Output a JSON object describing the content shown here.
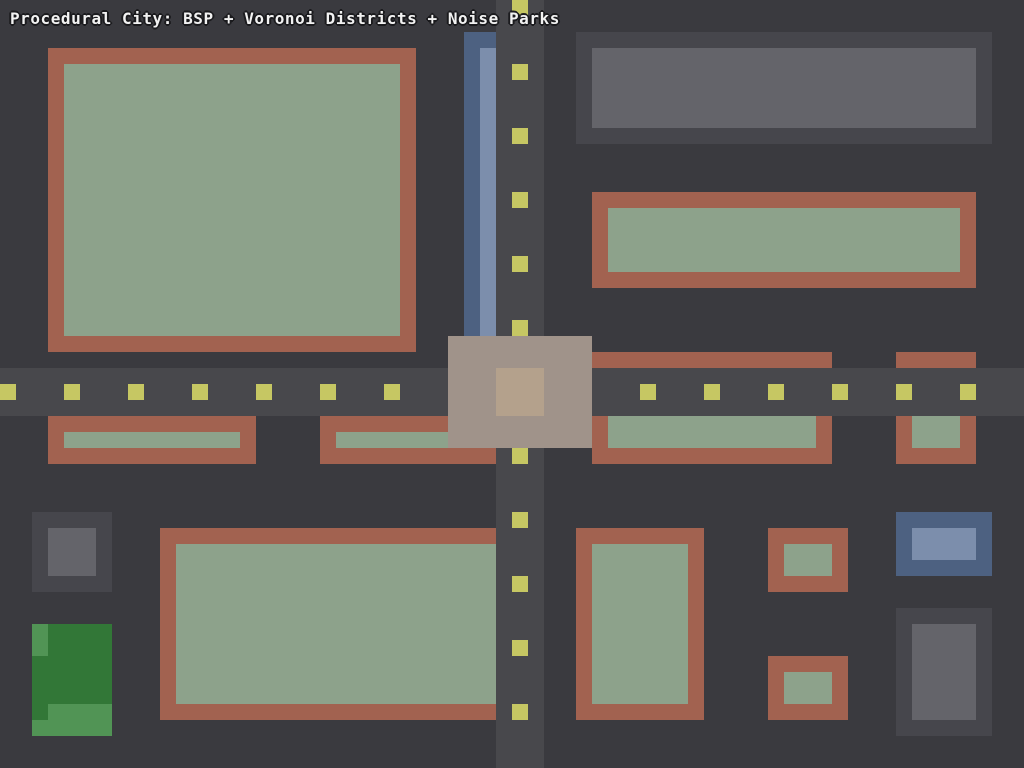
{
  "header": {
    "title": "Procedural City: BSP + Voronoi Districts + Noise Parks"
  },
  "scene": {
    "width": 1024,
    "height": 768,
    "background_color": "#3a3a3f",
    "palette": {
      "road": "#48484c",
      "road_dash": "#c6c763",
      "building_border_brown": "#a26250",
      "building_fill_green": "#8da28b",
      "building_border_gray": "#46464c",
      "building_fill_gray": "#64646a",
      "building_border_blue": "#4d6181",
      "building_fill_blue": "#7c8eac",
      "plaza_outer": "#a0938a",
      "plaza_inner": "#b4a18c",
      "park_dark": "#327737",
      "park_light": "#519455",
      "title_text": "#f2f2f2"
    },
    "roads": [
      {
        "name": "road-vertical",
        "x": 496,
        "y": 0,
        "w": 48,
        "h": 768,
        "color": "#48484c"
      },
      {
        "name": "road-horizontal",
        "x": 0,
        "y": 368,
        "w": 1024,
        "h": 48,
        "color": "#48484c"
      }
    ],
    "dashes": {
      "color": "#c6c763",
      "size": 16,
      "vertical_lane_x": 512,
      "vertical_dash_ys": [
        0,
        64,
        128,
        192,
        256,
        320,
        448,
        512,
        576,
        640,
        704
      ],
      "horizontal_lane_y": 384,
      "horizontal_dash_xs": [
        0,
        64,
        128,
        192,
        256,
        320,
        384,
        640,
        704,
        768,
        832,
        896,
        960
      ]
    },
    "buildings": [
      {
        "name": "building-residential-topleft-large",
        "outer": {
          "x": 48,
          "y": 48,
          "w": 368,
          "h": 304,
          "color": "#a26250"
        },
        "inner": {
          "x": 64,
          "y": 64,
          "w": 336,
          "h": 272,
          "color": "#8da28b"
        }
      },
      {
        "name": "building-commercial-topright-gray",
        "outer": {
          "x": 576,
          "y": 32,
          "w": 416,
          "h": 112,
          "color": "#46464c"
        },
        "inner": {
          "x": 592,
          "y": 48,
          "w": 384,
          "h": 80,
          "color": "#64646a"
        }
      },
      {
        "name": "building-residential-midright-wide",
        "outer": {
          "x": 592,
          "y": 192,
          "w": 384,
          "h": 96,
          "color": "#a26250"
        },
        "inner": {
          "x": 608,
          "y": 208,
          "w": 352,
          "h": 64,
          "color": "#8da28b"
        }
      },
      {
        "name": "building-civic-blue-top-roadside",
        "outer": {
          "x": 464,
          "y": 32,
          "w": 80,
          "h": 304,
          "color": "#4d6181"
        },
        "inner": {
          "x": 480,
          "y": 48,
          "w": 64,
          "h": 288,
          "color": "#7c8eac"
        }
      },
      {
        "name": "building-strip-right-of-plaza",
        "outer": {
          "x": 592,
          "y": 352,
          "w": 240,
          "h": 112,
          "color": "#a26250"
        },
        "inner": {
          "x": 608,
          "y": 368,
          "w": 208,
          "h": 80,
          "color": "#8da28b"
        }
      },
      {
        "name": "building-strip-far-right",
        "outer": {
          "x": 896,
          "y": 352,
          "w": 80,
          "h": 112,
          "color": "#a26250"
        },
        "inner": {
          "x": 912,
          "y": 368,
          "w": 48,
          "h": 80,
          "color": "#8da28b"
        }
      },
      {
        "name": "building-strip-left-a",
        "outer": {
          "x": 48,
          "y": 416,
          "w": 208,
          "h": 48,
          "color": "#a26250"
        },
        "inner": {
          "x": 64,
          "y": 432,
          "w": 176,
          "h": 16,
          "color": "#8da28b"
        }
      },
      {
        "name": "building-strip-left-b",
        "outer": {
          "x": 320,
          "y": 416,
          "w": 176,
          "h": 48,
          "color": "#a26250"
        },
        "inner": {
          "x": 336,
          "y": 432,
          "w": 144,
          "h": 16,
          "color": "#8da28b"
        }
      },
      {
        "name": "building-residential-bottom-large",
        "outer": {
          "x": 160,
          "y": 528,
          "w": 352,
          "h": 192,
          "color": "#a26250"
        },
        "inner": {
          "x": 176,
          "y": 544,
          "w": 320,
          "h": 160,
          "color": "#8da28b"
        }
      },
      {
        "name": "building-residential-bottom-tall",
        "outer": {
          "x": 576,
          "y": 528,
          "w": 128,
          "h": 192,
          "color": "#a26250"
        },
        "inner": {
          "x": 592,
          "y": 544,
          "w": 96,
          "h": 160,
          "color": "#8da28b"
        }
      },
      {
        "name": "building-small-bottom-mid-upper",
        "outer": {
          "x": 768,
          "y": 528,
          "w": 80,
          "h": 64,
          "color": "#a26250"
        },
        "inner": {
          "x": 784,
          "y": 544,
          "w": 48,
          "h": 32,
          "color": "#8da28b"
        }
      },
      {
        "name": "building-small-bottom-mid-lower",
        "outer": {
          "x": 768,
          "y": 656,
          "w": 80,
          "h": 64,
          "color": "#a26250"
        },
        "inner": {
          "x": 784,
          "y": 672,
          "w": 48,
          "h": 32,
          "color": "#8da28b"
        }
      },
      {
        "name": "building-civic-blue-bottomright",
        "outer": {
          "x": 896,
          "y": 512,
          "w": 96,
          "h": 64,
          "color": "#4d6181"
        },
        "inner": {
          "x": 912,
          "y": 528,
          "w": 64,
          "h": 32,
          "color": "#7c8eac"
        }
      },
      {
        "name": "building-commercial-bottomright",
        "outer": {
          "x": 896,
          "y": 608,
          "w": 96,
          "h": 128,
          "color": "#46464c"
        },
        "inner": {
          "x": 912,
          "y": 624,
          "w": 64,
          "h": 96,
          "color": "#64646a"
        }
      },
      {
        "name": "building-commercial-small-left",
        "outer": {
          "x": 32,
          "y": 512,
          "w": 80,
          "h": 80,
          "color": "#46464c"
        },
        "inner": {
          "x": 48,
          "y": 528,
          "w": 48,
          "h": 48,
          "color": "#64646a"
        }
      }
    ],
    "plaza": {
      "name": "plaza-intersection",
      "outer": {
        "x": 448,
        "y": 336,
        "w": 144,
        "h": 112,
        "color": "#a0938a"
      },
      "inner": {
        "x": 496,
        "y": 368,
        "w": 48,
        "h": 48,
        "color": "#b4a18c"
      }
    },
    "park": {
      "name": "noise-park-bottomleft",
      "base": {
        "x": 32,
        "y": 624,
        "w": 80,
        "h": 112,
        "color": "#327737"
      },
      "patches": [
        {
          "x": 32,
          "y": 624,
          "w": 16,
          "h": 32,
          "color": "#519455"
        },
        {
          "x": 48,
          "y": 704,
          "w": 64,
          "h": 32,
          "color": "#519455"
        },
        {
          "x": 32,
          "y": 720,
          "w": 16,
          "h": 16,
          "color": "#519455"
        }
      ]
    }
  }
}
